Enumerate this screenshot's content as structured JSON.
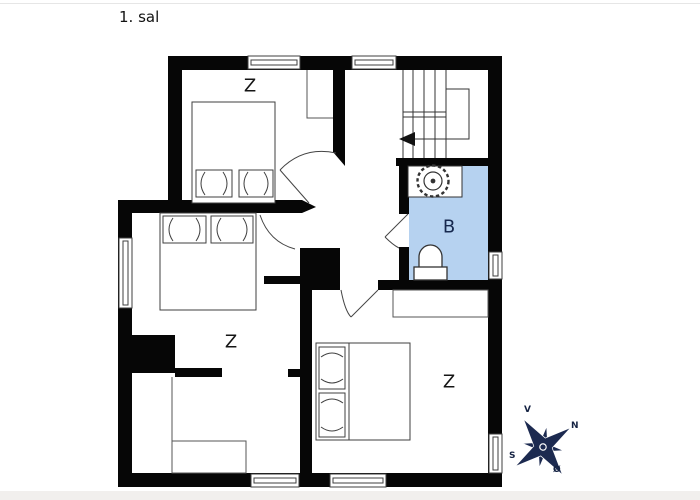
{
  "page": {
    "title": "1. sal"
  },
  "floor_plan": {
    "rooms": [
      {
        "name": "bedroom-top",
        "label": "Z"
      },
      {
        "name": "bedroom-left",
        "label": "Z"
      },
      {
        "name": "bedroom-bottom-right",
        "label": "Z"
      },
      {
        "name": "bathroom",
        "label": "B"
      }
    ],
    "icons": {
      "sink": "scalloped-circle",
      "toilet": "rounded-bowl",
      "stairs_direction": "left-arrow",
      "compass": "eight-point-star"
    }
  },
  "compass": {
    "north_label": "N",
    "south_label": "S",
    "east_label": "Ø",
    "west_label": "V"
  },
  "colors": {
    "wall": "#060606",
    "line": "#3f3f3f",
    "bathroom_fill": "#b6d2f0",
    "compass_navy": "#1c2a50",
    "label": "#151515",
    "background": "#ffffff"
  }
}
